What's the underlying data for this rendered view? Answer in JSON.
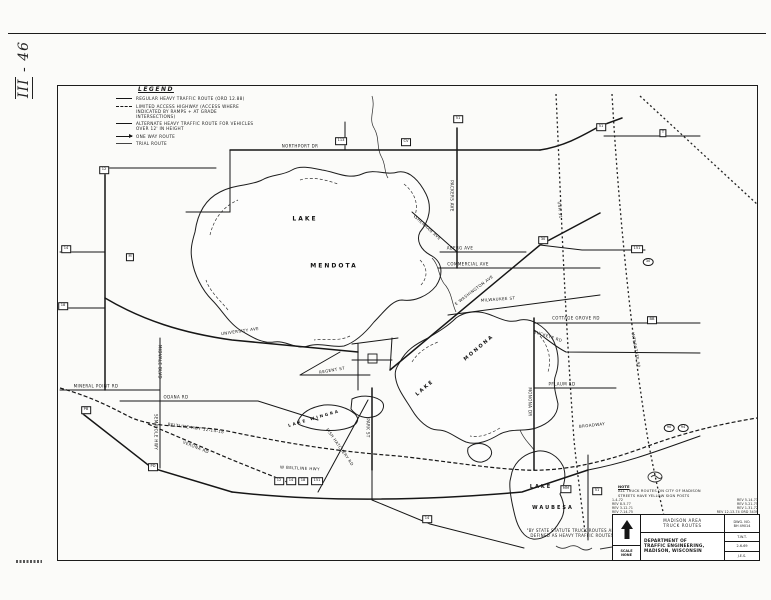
{
  "page": {
    "margin_annotation_roman": "III",
    "margin_annotation_number": "- 46"
  },
  "legend": {
    "title": "LEGEND",
    "items": [
      {
        "style": "solid",
        "label": "REGULAR HEAVY TRAFFIC ROUTE (ORD 12.88)"
      },
      {
        "style": "dashed",
        "label": "LIMITED ACCESS HIGHWAY (ACCESS WHERE INDICATED BY RAMPS + AT GRADE INTERSECTIONS)"
      },
      {
        "style": "solid-thin",
        "label": "ALTERNATE HEAVY TRAFFIC ROUTE FOR VEHICLES OVER 12' IN HEIGHT"
      },
      {
        "style": "arrow",
        "label": "ONE WAY ROUTE"
      },
      {
        "style": "trial",
        "label": "TRIAL ROUTE"
      }
    ]
  },
  "map": {
    "lake_labels": [
      {
        "t": "LAKE",
        "x": 305,
        "y": 219,
        "r": 0,
        "s": 6
      },
      {
        "t": "MENDOTA",
        "x": 334,
        "y": 266,
        "r": 0,
        "s": 6
      },
      {
        "t": "MONONA",
        "x": 479,
        "y": 348,
        "r": -40,
        "s": 5
      },
      {
        "t": "LAKE",
        "x": 425,
        "y": 388,
        "r": -40,
        "s": 5
      },
      {
        "t": "LAKE WINGRA",
        "x": 314,
        "y": 418,
        "r": -16,
        "s": 4
      },
      {
        "t": "LAKE",
        "x": 541,
        "y": 487,
        "r": 0,
        "s": 5
      },
      {
        "t": "WAUBESA",
        "x": 553,
        "y": 508,
        "r": 0,
        "s": 5
      }
    ],
    "road_labels": [
      {
        "t": "UNIVERSITY AVE",
        "x": 240,
        "y": 331,
        "r": -8
      },
      {
        "t": "MINERAL POINT RD",
        "x": 96,
        "y": 386,
        "r": 0
      },
      {
        "t": "ODANA RD",
        "x": 176,
        "y": 397,
        "r": 0
      },
      {
        "t": "SEMINOLE HWY",
        "x": 156,
        "y": 432,
        "r": 90
      },
      {
        "t": "VERONA RD",
        "x": 196,
        "y": 447,
        "r": 22
      },
      {
        "t": "BELTLINE HWY 12-14-18",
        "x": 196,
        "y": 428,
        "r": 8
      },
      {
        "t": "MIDVALE BLVD",
        "x": 160,
        "y": 362,
        "r": 90
      },
      {
        "t": "REGENT ST",
        "x": 332,
        "y": 370,
        "r": -10
      },
      {
        "t": "PARK ST",
        "x": 368,
        "y": 428,
        "r": 90
      },
      {
        "t": "FISH HATCHERY RD",
        "x": 340,
        "y": 447,
        "r": 55
      },
      {
        "t": "W BELTLINE HWY",
        "x": 300,
        "y": 468,
        "r": 3
      },
      {
        "t": "E WASHINGTON AVE",
        "x": 474,
        "y": 290,
        "r": -37
      },
      {
        "t": "MILWAUKEE ST",
        "x": 498,
        "y": 299,
        "r": -4
      },
      {
        "t": "COMMERCIAL AVE",
        "x": 468,
        "y": 264,
        "r": 0
      },
      {
        "t": "ABERG AVE",
        "x": 460,
        "y": 248,
        "r": 0
      },
      {
        "t": "PACKERS AVE",
        "x": 452,
        "y": 196,
        "r": 90
      },
      {
        "t": "NORTHPORT DR",
        "x": 300,
        "y": 146,
        "r": 0
      },
      {
        "t": "SHERMAN AVE",
        "x": 428,
        "y": 228,
        "r": 42
      },
      {
        "t": "COTTAGE GROVE RD",
        "x": 576,
        "y": 318,
        "r": 0
      },
      {
        "t": "BUCKEYE RD",
        "x": 548,
        "y": 336,
        "r": 18
      },
      {
        "t": "PFLAUM RD",
        "x": 562,
        "y": 384,
        "r": 0
      },
      {
        "t": "MONONA DR",
        "x": 530,
        "y": 402,
        "r": 90
      },
      {
        "t": "BROADWAY",
        "x": 592,
        "y": 425,
        "r": -6
      },
      {
        "t": "USH 51",
        "x": 560,
        "y": 210,
        "r": 84
      },
      {
        "t": "INTERSTATE 90",
        "x": 636,
        "y": 350,
        "r": 80
      }
    ],
    "shields": [
      {
        "t": "14",
        "x": 66,
        "y": 249,
        "shape": "box"
      },
      {
        "t": "12",
        "x": 104,
        "y": 170,
        "shape": "box"
      },
      {
        "t": "18",
        "x": 63,
        "y": 306,
        "shape": "box"
      },
      {
        "t": "M",
        "x": 130,
        "y": 257,
        "shape": "box"
      },
      {
        "t": "PB",
        "x": 86,
        "y": 410,
        "shape": "box"
      },
      {
        "t": "PD",
        "x": 153,
        "y": 467,
        "shape": "box"
      },
      {
        "t": "12",
        "x": 279,
        "y": 481,
        "shape": "box"
      },
      {
        "t": "14",
        "x": 291,
        "y": 481,
        "shape": "box"
      },
      {
        "t": "18",
        "x": 303,
        "y": 481,
        "shape": "box"
      },
      {
        "t": "151",
        "x": 317,
        "y": 481,
        "shape": "box"
      },
      {
        "t": "113",
        "x": 341,
        "y": 141,
        "shape": "box"
      },
      {
        "t": "CV",
        "x": 406,
        "y": 142,
        "shape": "box"
      },
      {
        "t": "51",
        "x": 458,
        "y": 119,
        "shape": "box"
      },
      {
        "t": "30",
        "x": 543,
        "y": 240,
        "shape": "box"
      },
      {
        "t": "151",
        "x": 637,
        "y": 249,
        "shape": "box"
      },
      {
        "t": "51",
        "x": 601,
        "y": 127,
        "shape": "box"
      },
      {
        "t": "T",
        "x": 663,
        "y": 133,
        "shape": "box"
      },
      {
        "t": "BB",
        "x": 652,
        "y": 320,
        "shape": "box"
      },
      {
        "t": "MM",
        "x": 566,
        "y": 489,
        "shape": "box"
      },
      {
        "t": "51",
        "x": 597,
        "y": 491,
        "shape": "box"
      },
      {
        "t": "14",
        "x": 427,
        "y": 519,
        "shape": "box"
      },
      {
        "t": "90",
        "x": 669,
        "y": 428,
        "shape": "oval"
      },
      {
        "t": "94",
        "x": 683,
        "y": 428,
        "shape": "oval"
      },
      {
        "t": "30",
        "x": 648,
        "y": 262,
        "shape": "oval"
      }
    ]
  },
  "note": {
    "title": "NOTE",
    "lines": [
      "ALL TRUCK ROUTES ON CITY OF MADISON",
      "STREETS HAVE YELLOW SIGN POSTS"
    ],
    "revisions_left": [
      "1-4-72",
      "REV 8-5-77",
      "REV 3-12-71",
      "REV 7-14-75"
    ],
    "revisions_right": [
      "REV 5-14-73",
      "REV 5-21-75",
      "REV 1-31-72",
      "REV 12-13-74 ORD 3439"
    ]
  },
  "statute_note": {
    "line1": "\"BY STATE STATUTE TRUCK ROUTES ARE",
    "line2": "DEFINED AS HEAVY TRAFFIC ROUTES"
  },
  "title_block": {
    "area_line1": "MADISON AREA",
    "area_line2": "TRUCK ROUTES",
    "dwg_label": "DWG. NO.",
    "dwg_no": "BH 49014",
    "dept_line1": "DEPARTMENT OF",
    "dept_line2": "TRAFFIC ENGINEERING,",
    "dept_line3": "MADISON, WISCONSIN",
    "scale_label": "SCALE",
    "scale_value": "NONE",
    "drawn_by": "T.W.T.",
    "date": "2-6-69",
    "checked_by": "J.E.S."
  }
}
